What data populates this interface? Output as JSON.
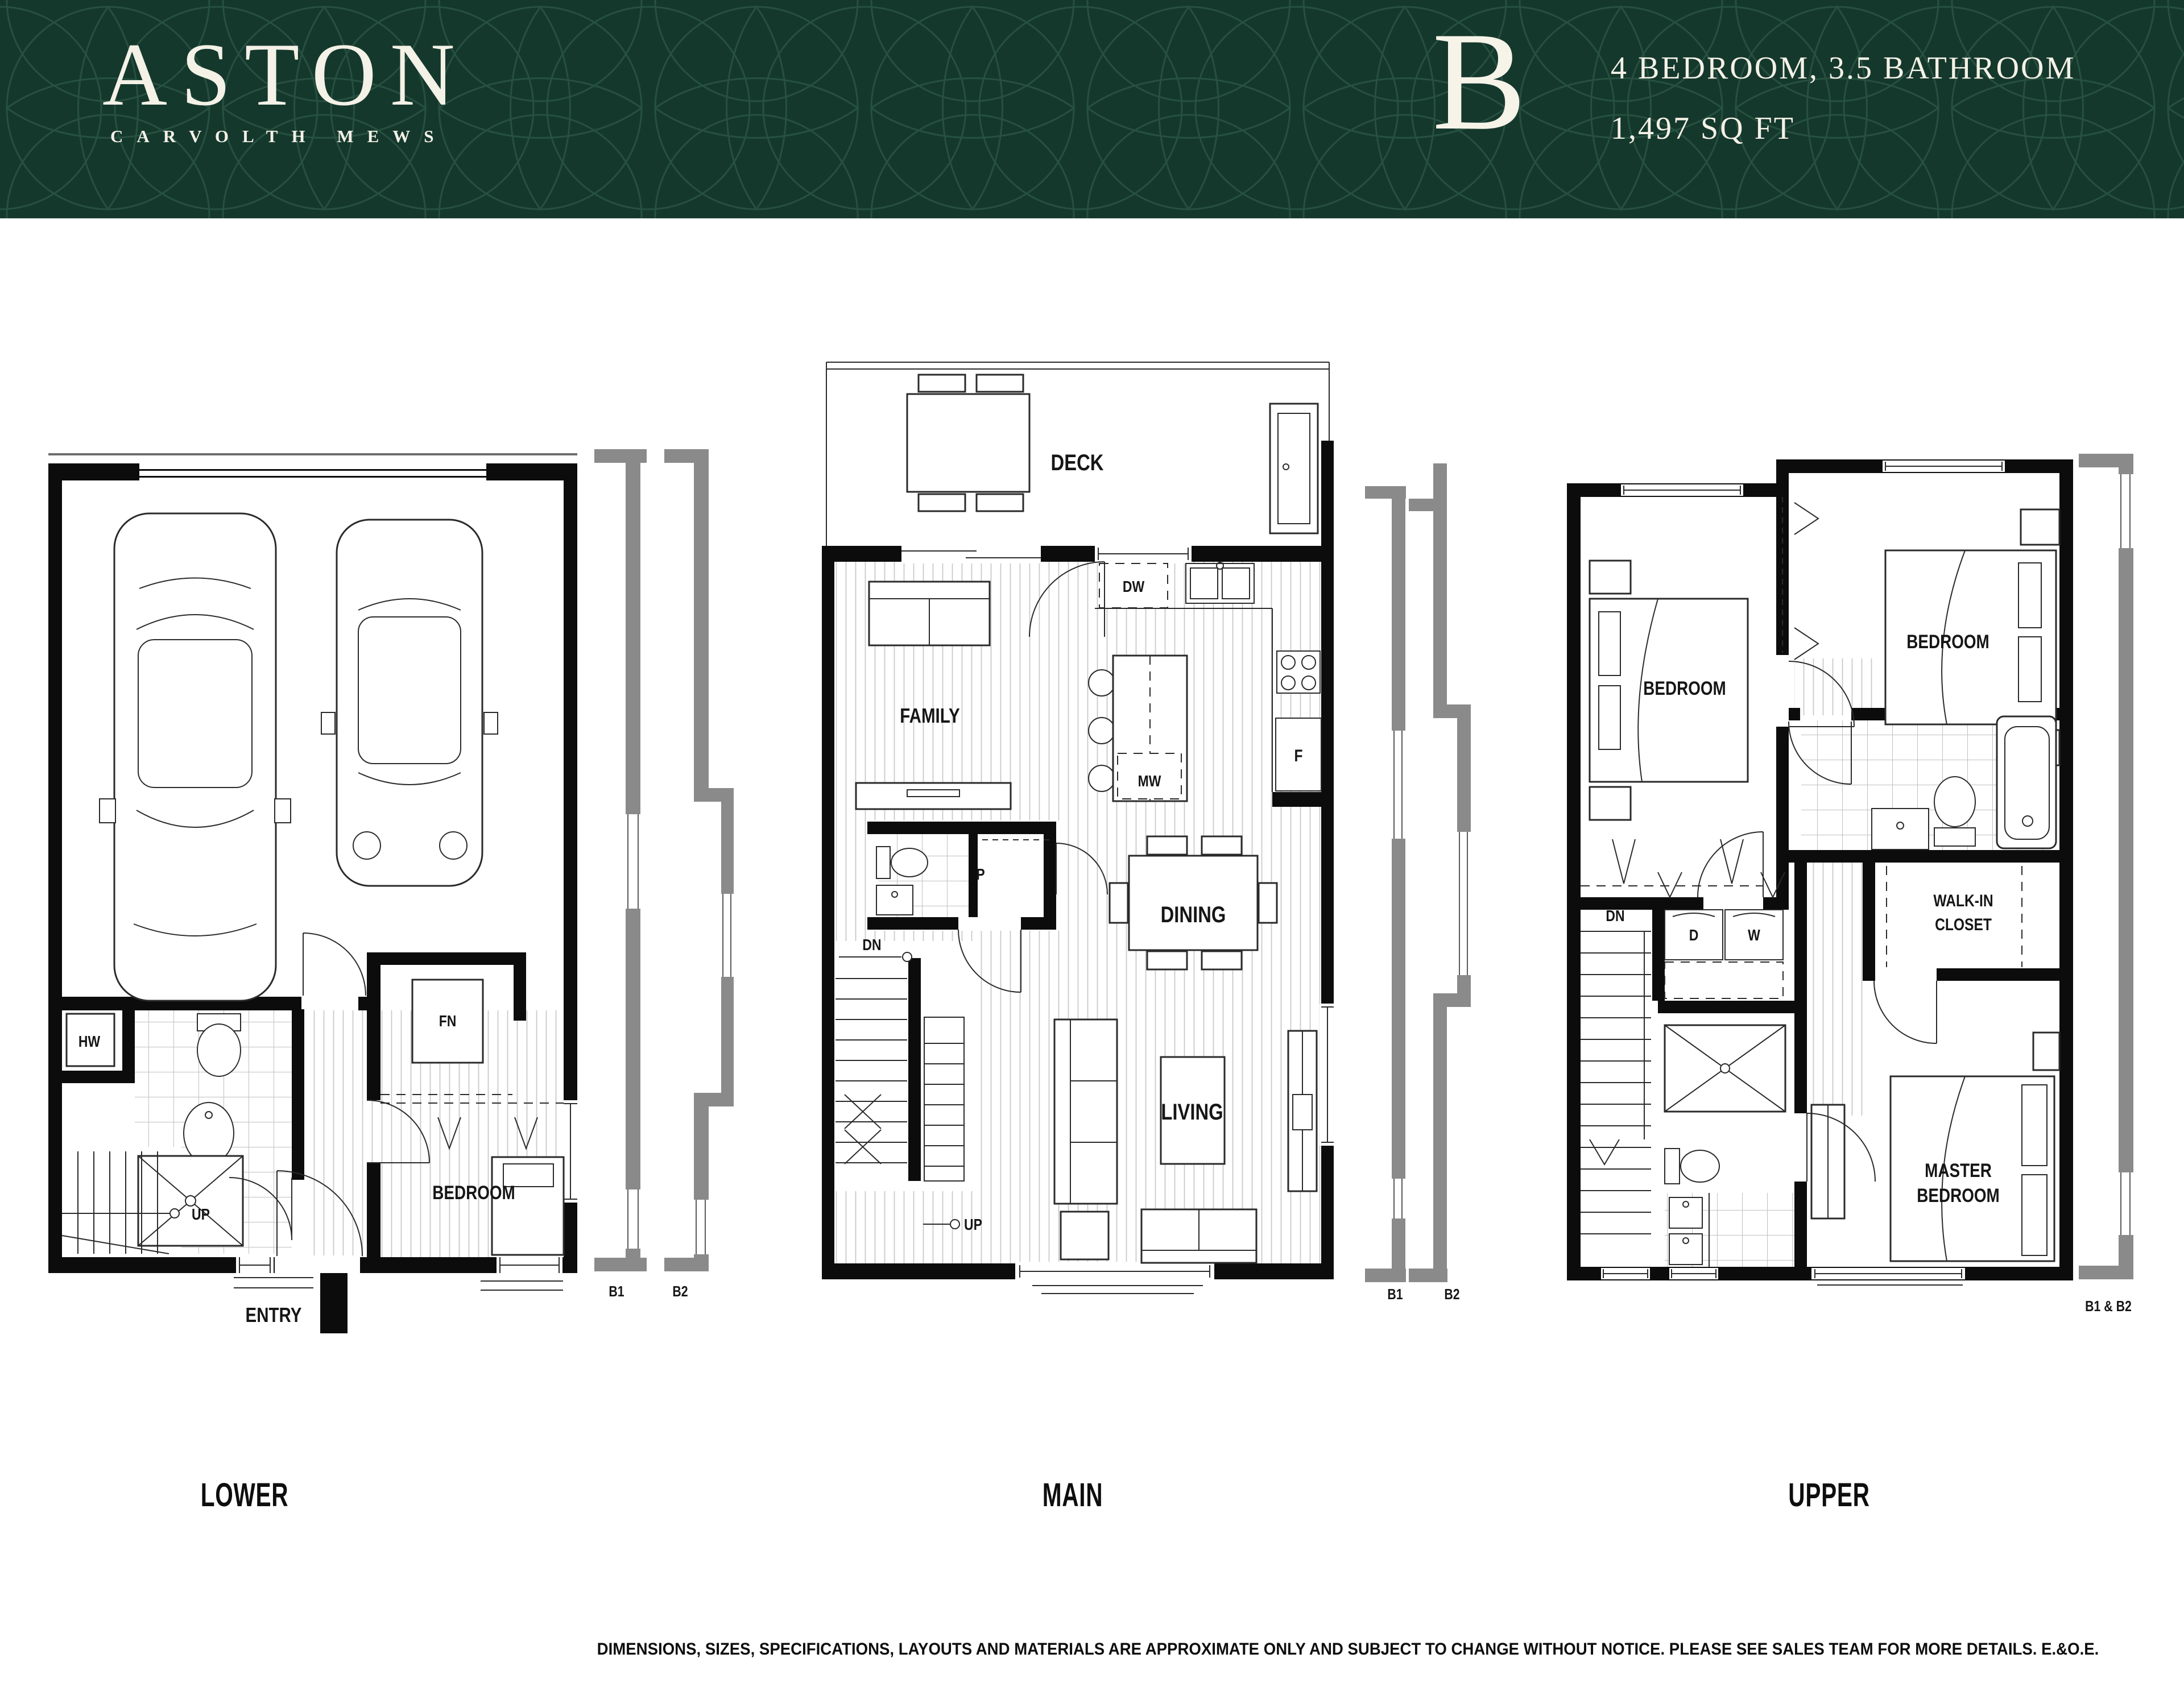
{
  "header": {
    "logo": {
      "title": "ASTON",
      "subtitle": "CARVOLTH MEWS"
    },
    "plan": {
      "letter": "B",
      "spec_line1": "4 BEDROOM, 3.5 BATHROOM",
      "spec_line2": "1,497 SQ FT"
    },
    "colors": {
      "background": "#15382d",
      "pattern": "#2c5847",
      "text": "#f4f1e6"
    }
  },
  "floors": {
    "lower": {
      "title": "LOWER",
      "labels": {
        "hw": "HW",
        "fn": "FN",
        "up": "UP",
        "bedroom": "BEDROOM",
        "entry": "ENTRY"
      }
    },
    "main": {
      "title": "MAIN",
      "labels": {
        "deck": "DECK",
        "family": "FAMILY",
        "dw": "DW",
        "p": "P",
        "mw": "MW",
        "f": "F",
        "dn": "DN",
        "dining": "DINING",
        "living": "LIVING",
        "up": "UP"
      }
    },
    "upper": {
      "title": "UPPER",
      "labels": {
        "bedroom_left": "BEDROOM",
        "bedroom_right": "BEDROOM",
        "walkin_line1": "WALK-IN",
        "walkin_line2": "CLOSET",
        "dn": "DN",
        "d": "D",
        "w": "W",
        "master_line1": "MASTER",
        "master_line2": "BEDROOM"
      }
    }
  },
  "sections": {
    "lower_main": {
      "b1": "B1",
      "b2": "B2"
    },
    "main_upper": {
      "b1": "B1",
      "b2": "B2"
    },
    "upper": {
      "combined": "B1 & B2"
    }
  },
  "plan_colors": {
    "wall": "#0c0c0c",
    "section_gray": "#8a8a8a",
    "hatch": "#c9c9c9"
  },
  "footer": {
    "disclaimer": "DIMENSIONS, SIZES, SPECIFICATIONS, LAYOUTS AND MATERIALS ARE APPROXIMATE ONLY AND SUBJECT TO CHANGE WITHOUT NOTICE. PLEASE SEE SALES TEAM FOR MORE DETAILS. E.&O.E."
  }
}
